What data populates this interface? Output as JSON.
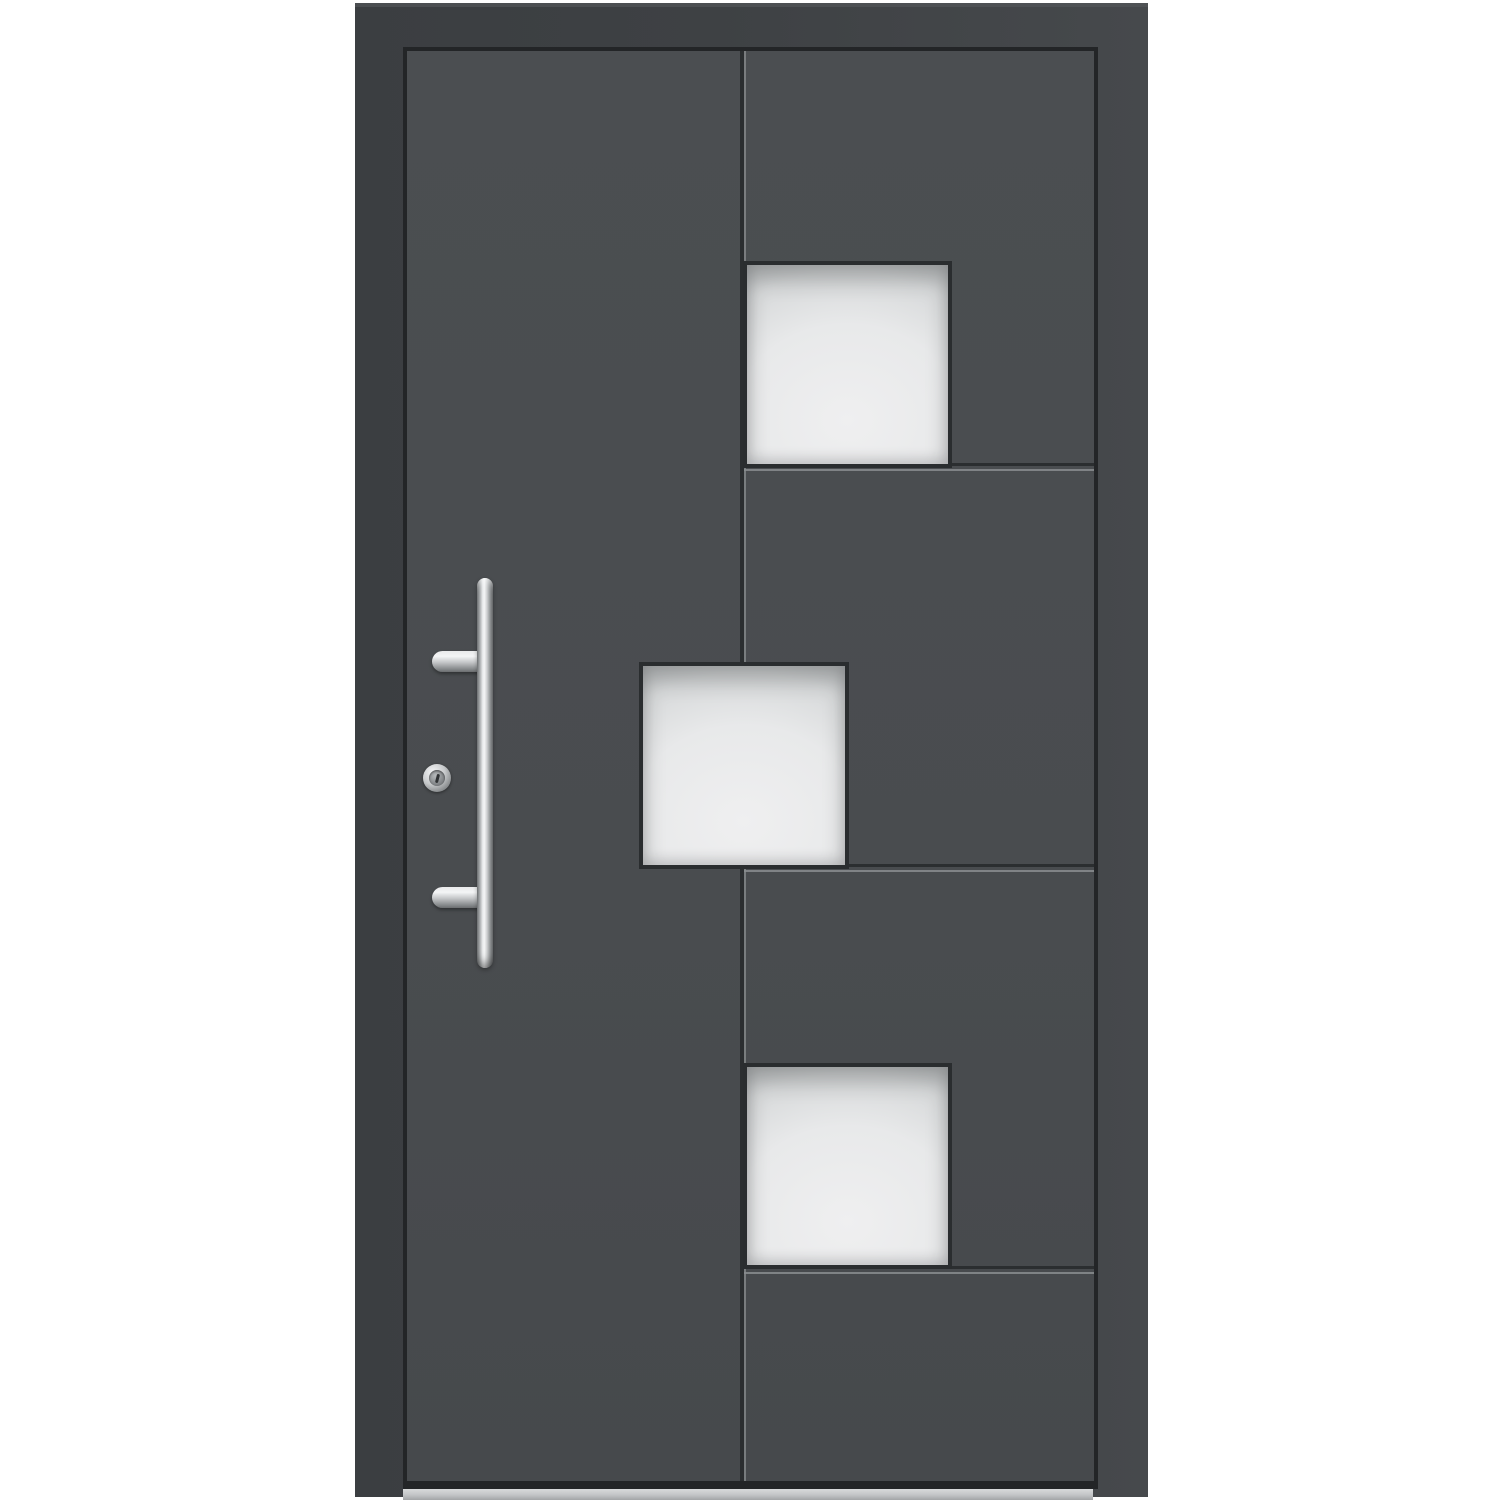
{
  "meta": {
    "type": "product-photo",
    "subject": "Modern anthracite-grey aluminium entrance door with three square frosted glass panels, vertical stainless-steel bar handle, profile cylinder lock and aluminium threshold",
    "visible_text": "none"
  },
  "door": {
    "frame": {
      "part": "outer door frame",
      "finish": "anthracite grey, matte"
    },
    "leaf": {
      "part": "door leaf",
      "finish": "anthracite grey, matte",
      "grooves": {
        "vertical_count": 1,
        "horizontal_count": 3,
        "style": "dark shadow line with adjacent light highlight line"
      }
    },
    "glazing": {
      "count": 3,
      "shape": "square",
      "glass_type": "satinized frosted white",
      "panels": [
        {
          "position": "upper right, resting on first horizontal groove"
        },
        {
          "position": "middle, centered on the vertical groove"
        },
        {
          "position": "lower right, resting on third horizontal groove"
        }
      ]
    },
    "hardware": {
      "handle": {
        "type": "vertical bar pull handle",
        "finish": "brushed stainless steel",
        "mounts": 2,
        "side": "left of leaf"
      },
      "lock": {
        "type": "profile cylinder with round escutcheon",
        "finish": "stainless steel"
      }
    },
    "threshold": {
      "part": "aluminium sill",
      "finish": "silver grey"
    }
  },
  "colors": {
    "background": "#ffffff",
    "frame": "#3b3e41",
    "frame_edge": "#46494c",
    "gap_shadow": "#232527",
    "leaf": "#4b4e51",
    "groove_dark": "#2b2e30",
    "groove_light": "#8a8d8f",
    "glass_border": "#2a2d2f",
    "glass_bright": "#efeff0",
    "glass_mid": "#d7d9da",
    "glass_edge": "#9a9da0",
    "steel_bright": "#f4f5f6",
    "steel_mid": "#898c8e",
    "steel_dark": "#6b6e70",
    "keyhole": "#2f3234",
    "threshold_top": "#d8dadb",
    "threshold_bottom": "#a2a5a7"
  }
}
